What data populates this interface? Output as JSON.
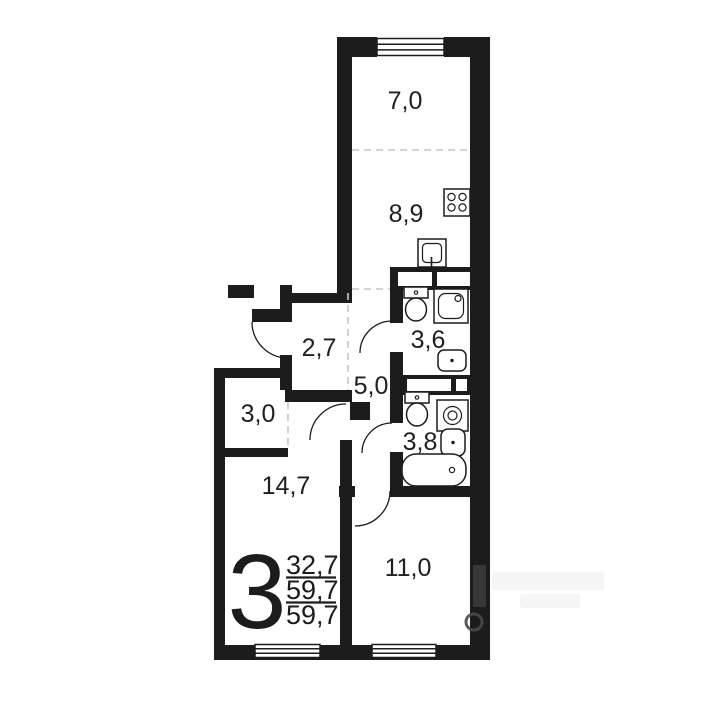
{
  "floor_plan": {
    "rooms": {
      "balcony": {
        "label": "7,0"
      },
      "kitchen": {
        "label": "8,9"
      },
      "bathroom_top": {
        "label": "3,6"
      },
      "entry_hall": {
        "label": "2,7"
      },
      "corridor": {
        "label": "5,0"
      },
      "bathroom_bottom": {
        "label": "3,8"
      },
      "wardrobe": {
        "label": "3,0"
      },
      "room_large": {
        "label": "14,7"
      },
      "room_small": {
        "label": "11,0"
      }
    },
    "summary": {
      "rooms_count": "3",
      "living_area": "32,7",
      "total_area": "59,7",
      "overall_area": "59,7"
    },
    "fixtures": [
      "stove",
      "kitchen-sink",
      "toilet",
      "shower",
      "washbasin",
      "washing-machine",
      "bathtub"
    ],
    "colors": {
      "wall": "#1c1c1c",
      "dashed_divider": "#c6c6c6",
      "label_text": "#1f1f1f",
      "background": "#ffffff"
    }
  }
}
